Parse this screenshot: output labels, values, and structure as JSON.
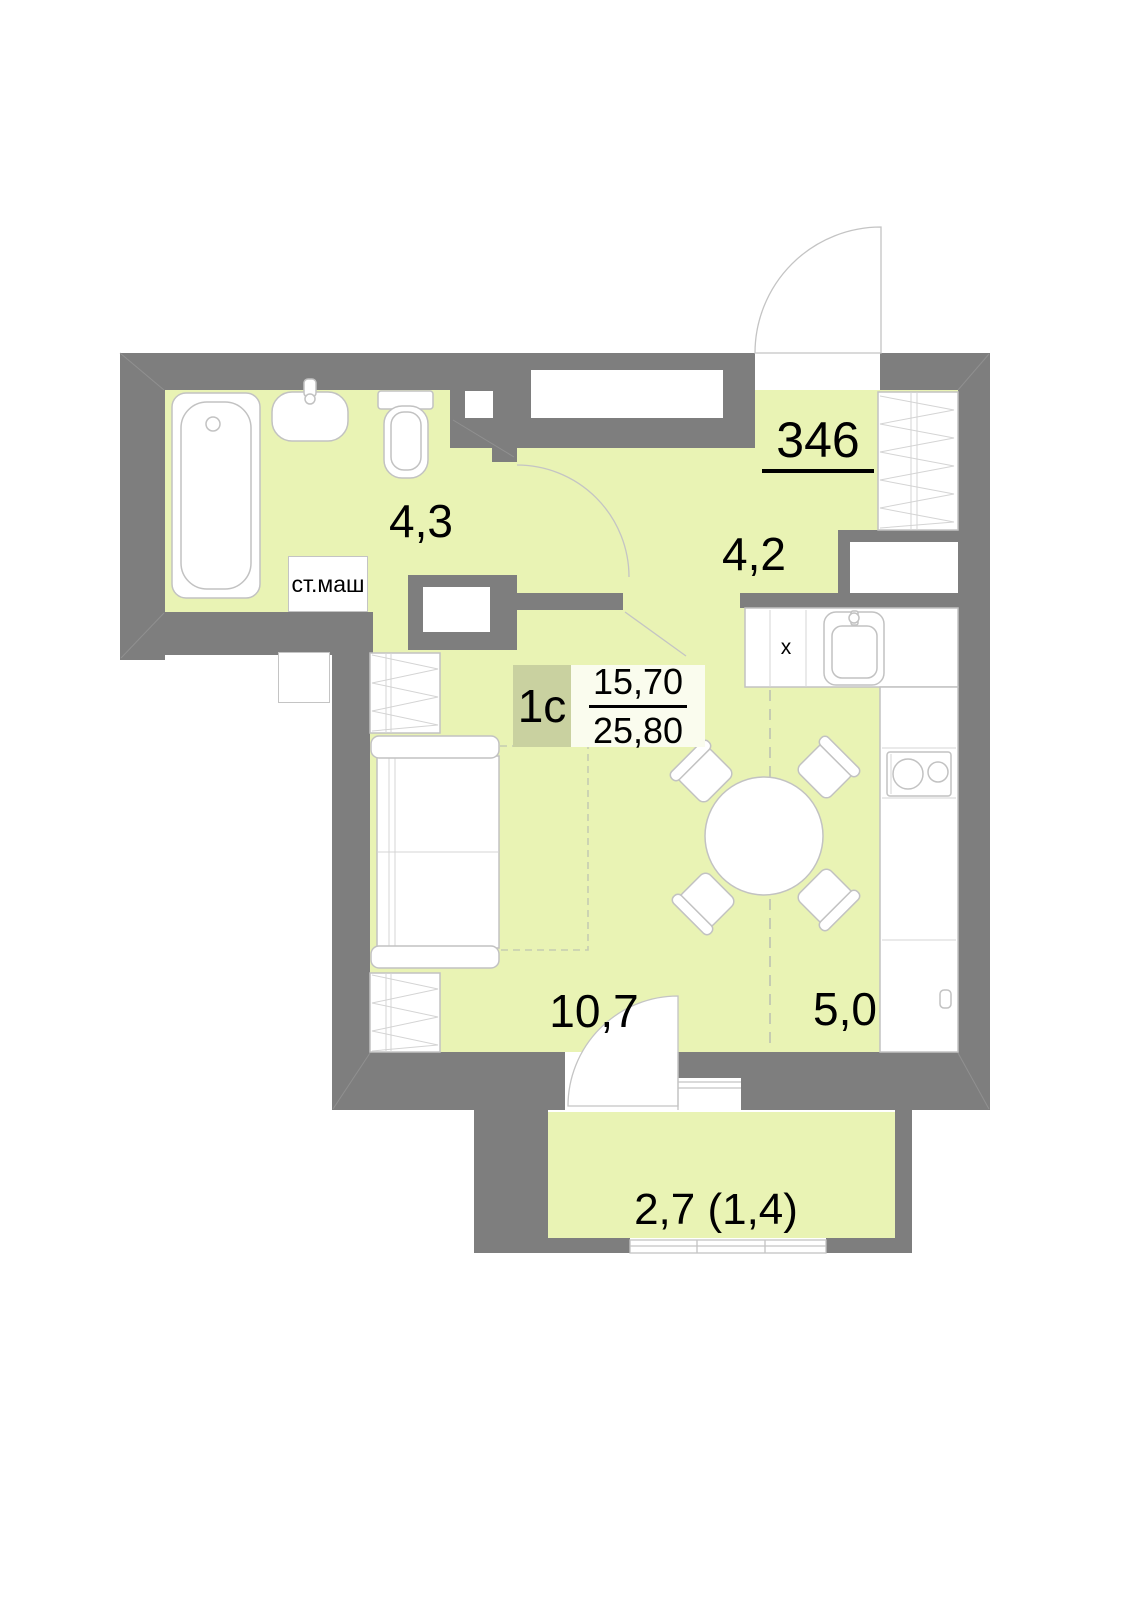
{
  "plan": {
    "apartment_number": "346",
    "unit": {
      "type_label": "1с",
      "living_area": "15,70",
      "total_area": "25,80"
    },
    "rooms": [
      {
        "id": "bathroom",
        "area": "4,3"
      },
      {
        "id": "hallway",
        "area": "4,2"
      },
      {
        "id": "living-room",
        "area": "10,7"
      },
      {
        "id": "kitchen",
        "area": "5,0"
      },
      {
        "id": "balcony",
        "area": "2,7 (1,4)"
      }
    ],
    "annotations": {
      "washing_machine": "ст.маш",
      "kitchen_mark": "x"
    }
  },
  "colors": {
    "wall": "#7e7e7e",
    "room": "#e9f3b4",
    "badge": "#c9d1a0",
    "fractionBg": "#fafcee",
    "line": "#c2c2c2",
    "lineLight": "#d4d4d4",
    "dash": "#c6ccb2",
    "doorline": "#c4c4c4",
    "text": "#000000"
  }
}
